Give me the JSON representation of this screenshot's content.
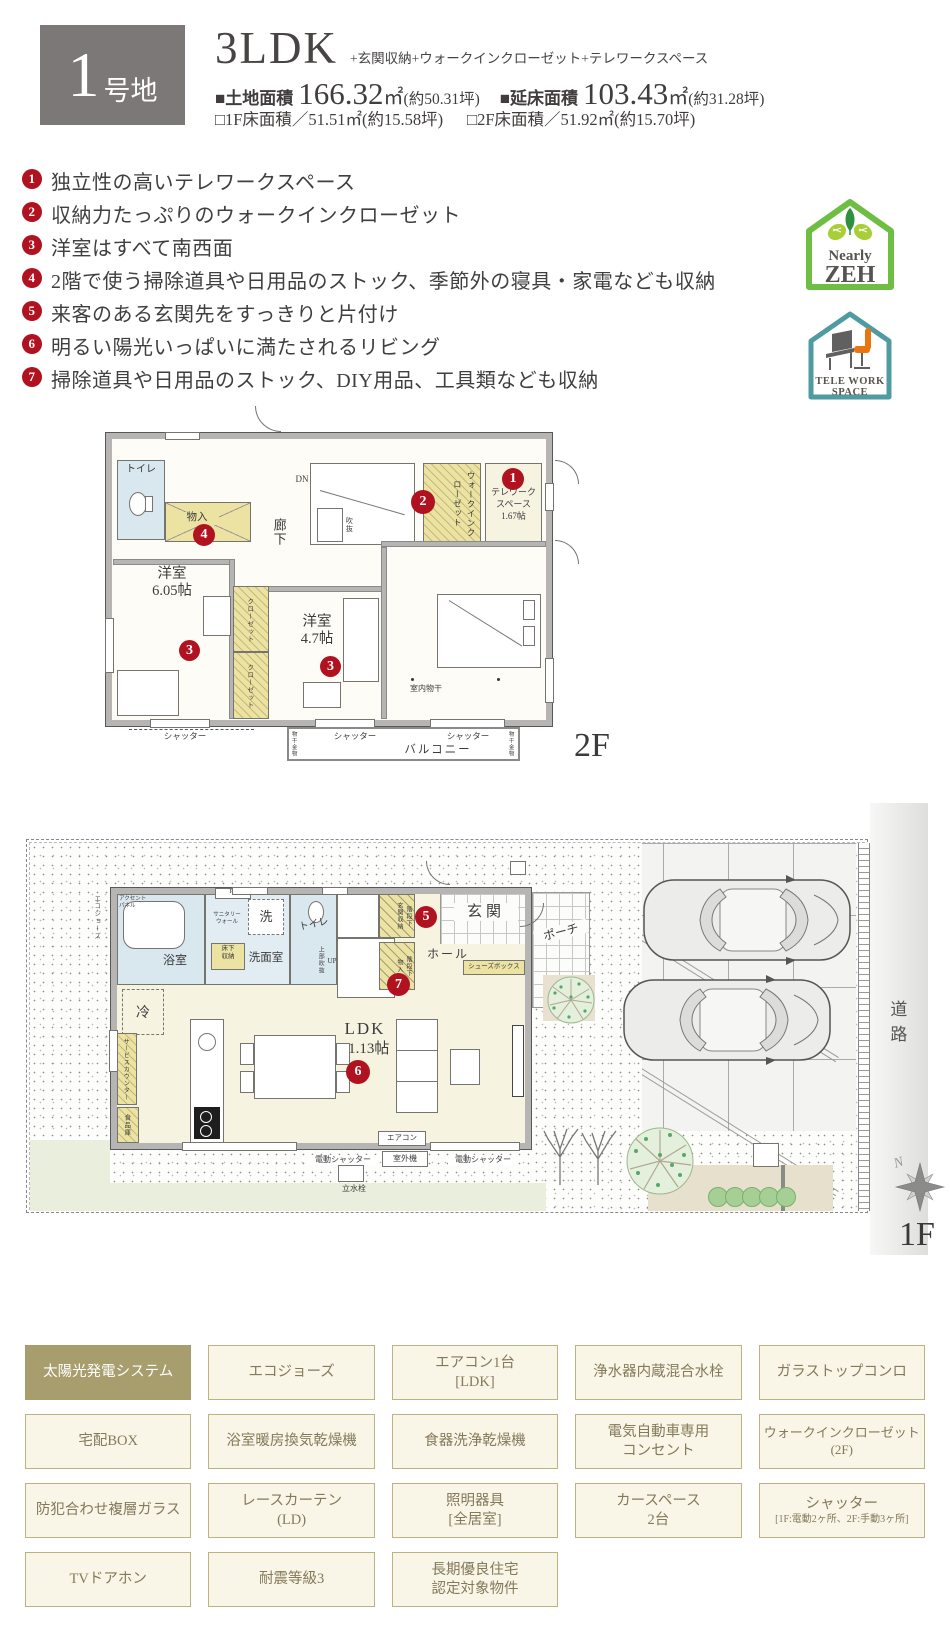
{
  "header": {
    "lot_number": "1",
    "lot_suffix": "号地",
    "plan_type": "3LDK",
    "plan_extras": "+玄関収納+ウォークインクローゼット+テレワークスペース",
    "land_label": "■土地面積",
    "land_value": "166.32",
    "land_unit": "㎡",
    "land_tsubo": "(約50.31坪)",
    "total_label": "■延床面積",
    "total_value": "103.43",
    "total_unit": "㎡",
    "total_tsubo": "(約31.28坪)",
    "f1_area": "□1F床面積／51.51㎡(約15.58坪)",
    "f2_area": "□2F床面積／51.92㎡(約15.70坪)"
  },
  "features": [
    {
      "num": "1",
      "text": "独立性の高いテレワークスペース"
    },
    {
      "num": "2",
      "text": "収納力たっぷりのウォークインクローゼット"
    },
    {
      "num": "3",
      "text": "洋室はすべて南西面"
    },
    {
      "num": "4",
      "text": "2階で使う掃除道具や日用品のストック、季節外の寝具・家電なども収納"
    },
    {
      "num": "5",
      "text": "来客のある玄関先をすっきりと片付け"
    },
    {
      "num": "6",
      "text": "明るい陽光いっぱいに満たされるリビング"
    },
    {
      "num": "7",
      "text": "掃除道具や日用品のストック、DIY用品、工具類なども収納"
    }
  ],
  "badges": {
    "zeh_top": "Nearly",
    "zeh_main": "ZEH",
    "telework_line1": "TELE WORK",
    "telework_line2": "SPACE"
  },
  "plan2f": {
    "floor": "2F",
    "toilet": "トイレ",
    "storage": "物入",
    "hallway": "廊下",
    "dn": "DN",
    "void": "吹抜",
    "wic": "ウォークインクローゼット",
    "telework": "テレワーク\nスペース\n1.67帖",
    "room1": "洋室\n6.05帖",
    "room2": "洋室\n4.7帖",
    "master": "主寝室\n7.35帖",
    "monohoshi": "室内物干",
    "closet": "クローゼット",
    "shutter": "シャッター",
    "balcony": "バルコニー",
    "kanamono": "物干金物"
  },
  "plan1f": {
    "floor": "1F",
    "bath": "浴室",
    "accent": "アクセント\nパネル",
    "ps": "PS",
    "sanitary": "サニタリー\nウォール",
    "washer": "洗",
    "yukashita": "床下\n収納",
    "senmen": "洗面室",
    "toilet": "トイレ",
    "void_up": "上部吹抜",
    "up": "UP",
    "genkan_storage": "階段下\n玄関収納",
    "genkan": "玄関",
    "hall": "ホール",
    "shoes": "シューズボックス",
    "porch": "ポーチ",
    "kaidanshita": "階段下\n物入",
    "fridge": "冷",
    "service": "サービスカウンター",
    "pantry": "食品庫",
    "ldk": "LDK",
    "ldk_size": "21.13帖",
    "aircon": "エアコン",
    "e_shutter": "電動シャッター",
    "outdoor": "室外機",
    "tap": "立水栓",
    "pole": "ポール",
    "ecojozu": "エコジョーズ",
    "road": "道路",
    "north": "N"
  },
  "marker_numbers": [
    "1",
    "2",
    "3",
    "4",
    "5",
    "6",
    "7"
  ],
  "equipment": {
    "r1c1": "太陽光発電システム",
    "r1c2": "エコジョーズ",
    "r1c3": "エアコン1台\n[LDK]",
    "r1c4": "浄水器内蔵混合水栓",
    "r1c5": "ガラストップコンロ",
    "r2c1": "宅配BOX",
    "r2c2": "浴室暖房換気乾燥機",
    "r2c3": "食器洗浄乾燥機",
    "r2c4": "電気自動車専用\nコンセント",
    "r2c5": "ウォークインクローゼット\n(2F)",
    "r3c1": "防犯合わせ複層ガラス",
    "r3c2": "レースカーテン\n(LD)",
    "r3c3": "照明器具\n[全居室]",
    "r3c4": "カースペース\n2台",
    "r3c5_main": "シャッター",
    "r3c5_sub": "[1F:電動2ヶ所、2F:手動3ヶ所]",
    "r4c1": "TVドアホン",
    "r4c2": "耐震等級3",
    "r4c3": "長期優良住宅\n認定対象物件"
  },
  "colors": {
    "marker_red": "#b11220",
    "highlight_cell": "#a79d6d",
    "zeh_green": "#6fbe44",
    "telework_teal": "#4f9ba1",
    "chair_orange": "#e9750f"
  }
}
